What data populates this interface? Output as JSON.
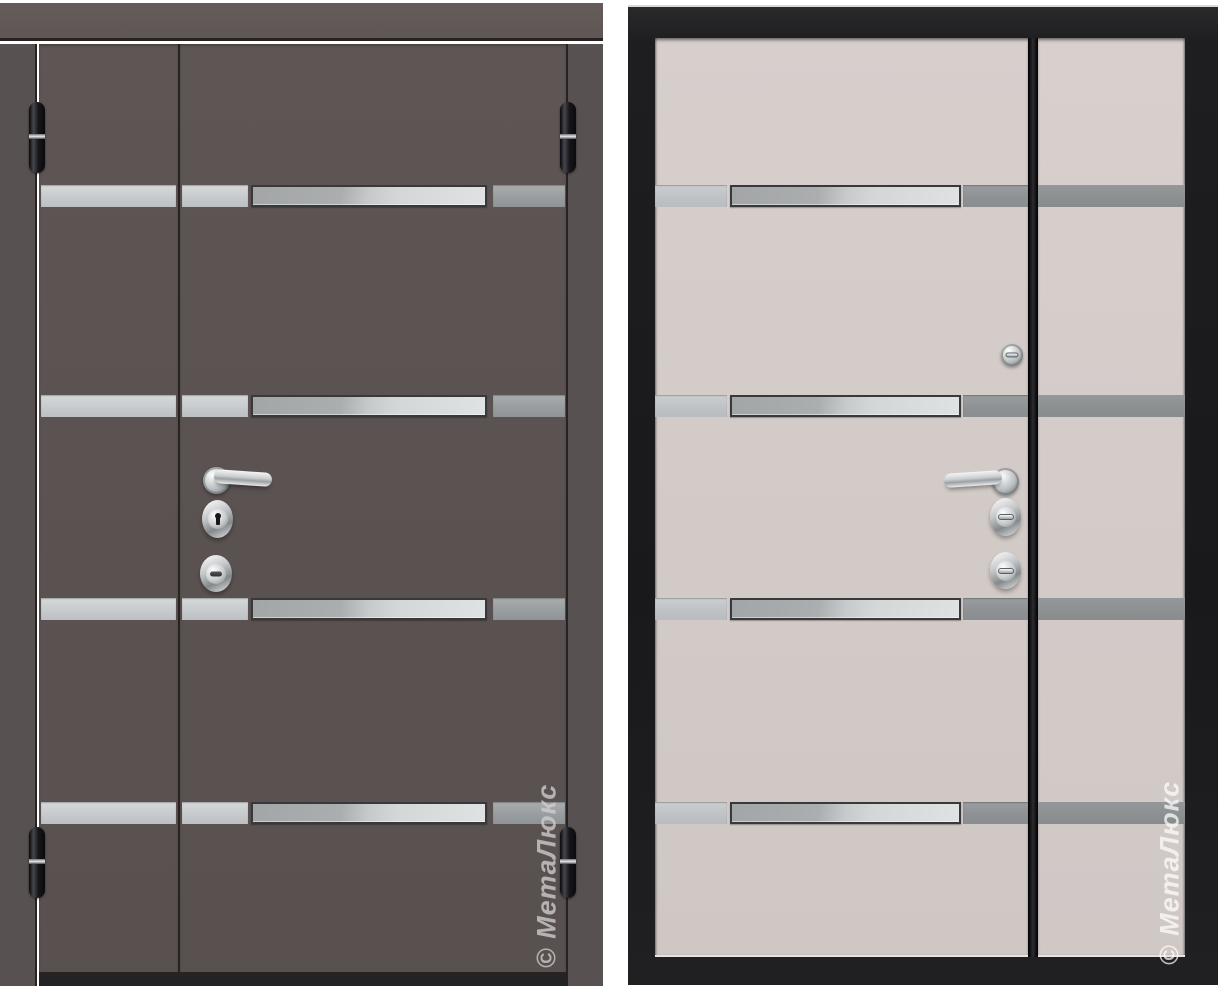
{
  "scene": {
    "type": "product-photo",
    "subject": "one-and-a-half leaf metal entrance door, exterior and interior views side by side"
  },
  "exterior_view": {
    "watermark": "© МетаЛюкс",
    "decor_strip_rows": 4,
    "visible_hinges": 4,
    "hardware": [
      "lever-handle",
      "key-cylinder-escutcheon",
      "armored-cylinder-escutcheon"
    ]
  },
  "interior_view": {
    "watermark": "© МетаЛюкс",
    "decor_strip_rows": 4,
    "hardware": [
      "deadbolt-thumbturn",
      "lever-handle",
      "thumbturn-escutcheon",
      "thumbturn-escutcheon"
    ]
  },
  "colors": {
    "background": "#ffffff",
    "exterior_leaf": "#5b5351",
    "exterior_header": "#5f5755",
    "exterior_jamb": "#585151",
    "seam_dark": "#282221",
    "threshold": "#232325",
    "interior_leaf": "#d3cbc7",
    "interior_side_panel": "#d4ccc9",
    "interior_frame": "#1e1e20",
    "separator_black": "#2c2c31",
    "strip_silver": "#c8cbcd",
    "strip_steel_left": "#a2a6a7",
    "strip_steel_right": "#dfe2e2",
    "strip_gray": "#989c9e",
    "strip_side_gray": "#8d9091",
    "chrome_light": "#f4f5f6",
    "chrome_mid": "#b9bdbf",
    "chrome_dark": "#84898c",
    "hinge_black": "#17171b",
    "watermark_exterior": "rgba(207,205,208,0.78)",
    "watermark_interior": "rgba(255,255,255,0.72)"
  }
}
